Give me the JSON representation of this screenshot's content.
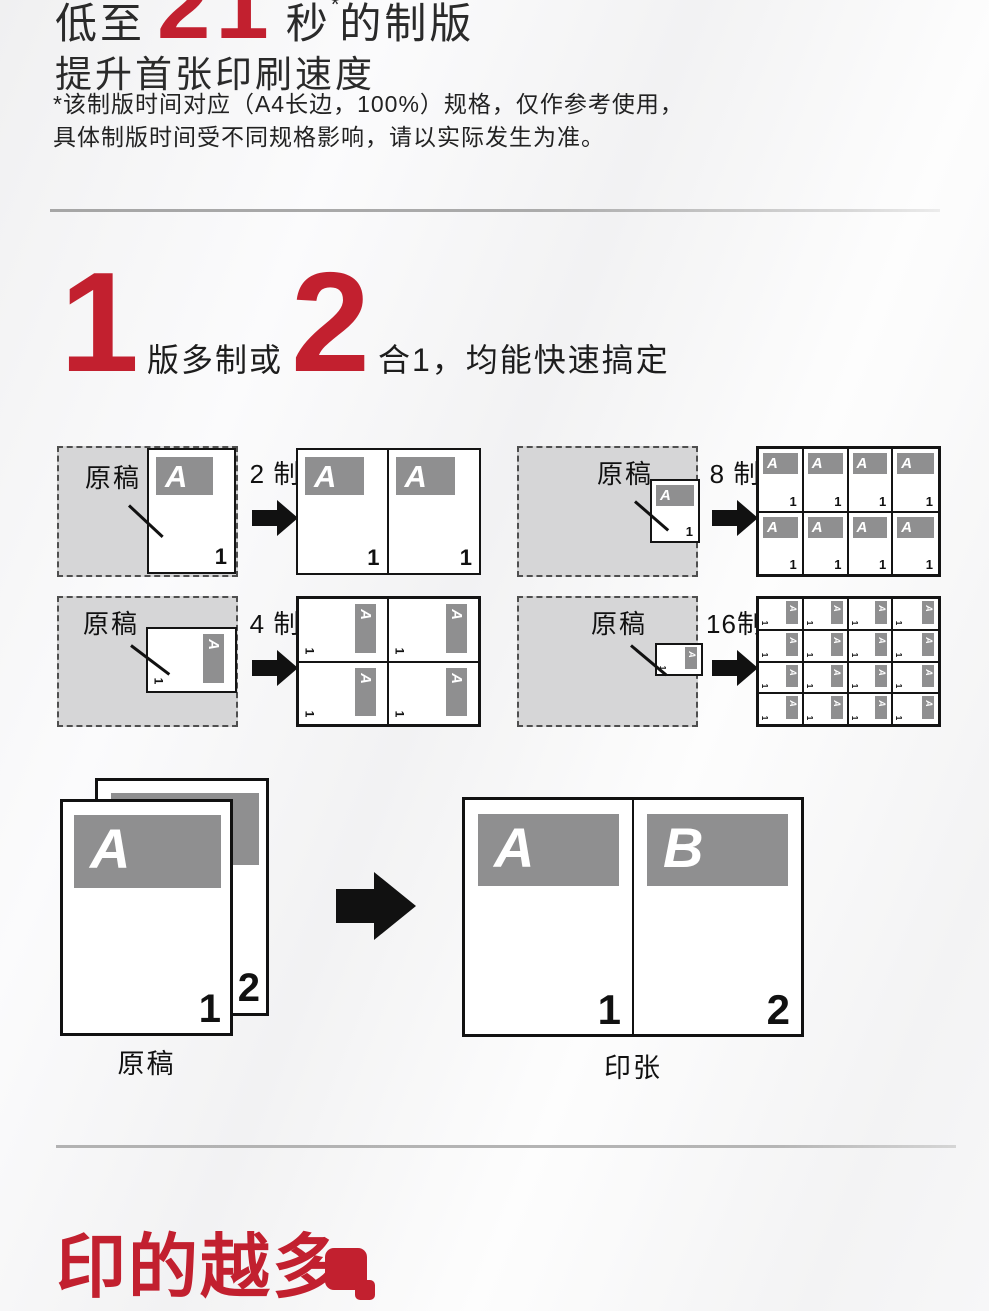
{
  "colors": {
    "accent_red": "#c2202f",
    "zone_gray": "#d6d6d7",
    "band_gray": "#8f8f90"
  },
  "hero": {
    "prefix": "低至",
    "number": "21",
    "unit": "秒",
    "asterisk": "*",
    "suffix": "的制版",
    "subtitle": "提升首张印刷速度",
    "note1": "*该制版时间对应（A4长边，100%）规格，仅作参考使用，",
    "note2": "具体制版时间受不同规格影响，请以实际发生为准。"
  },
  "feature": {
    "num1": "1",
    "text1": "版多制或",
    "num2": "2",
    "text2": "合1，均能快速搞定"
  },
  "diagrams": {
    "original_label": "原稿",
    "letter": "A",
    "number": "1",
    "items": [
      {
        "id": "2up",
        "label": "2 制",
        "cols": 2,
        "rows": 1,
        "rotated": false
      },
      {
        "id": "8up",
        "label": "8 制",
        "cols": 4,
        "rows": 2,
        "rotated": false
      },
      {
        "id": "4up",
        "label": "4 制",
        "cols": 2,
        "rows": 2,
        "rotated": true
      },
      {
        "id": "16up",
        "label": "16制",
        "cols": 4,
        "rows": 4,
        "rotated": true
      }
    ]
  },
  "merge": {
    "original_label": "原稿",
    "sheet_label": "印张",
    "originals": [
      {
        "letter": "A",
        "number": "1"
      },
      {
        "letter": "",
        "number": "2"
      }
    ],
    "sheet": [
      {
        "letter": "A",
        "number": "1"
      },
      {
        "letter": "B",
        "number": "2"
      }
    ]
  },
  "footer": {
    "title": "印的越多"
  }
}
